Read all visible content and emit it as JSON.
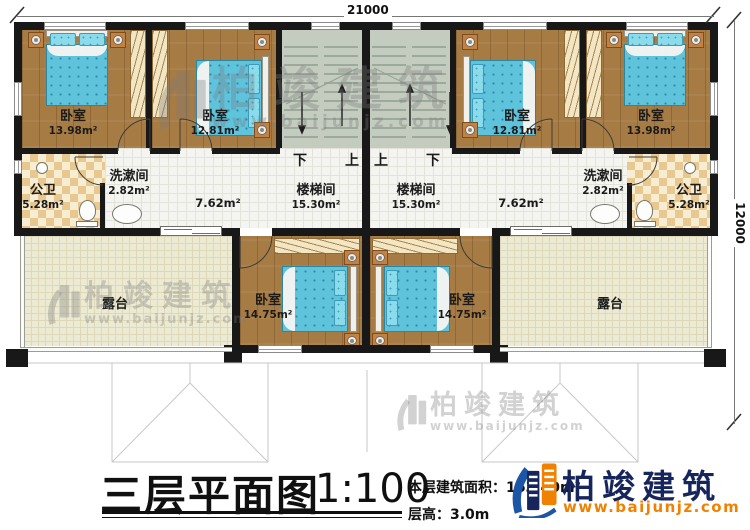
{
  "dimensions": {
    "width_mm": "21000",
    "depth_mm": "12000"
  },
  "stair_directions": {
    "left_down": "下",
    "left_up": "上",
    "right_up": "上",
    "right_down": "下"
  },
  "rooms": {
    "bedroom_top_left": {
      "name": "卧室",
      "area": "13.98m²"
    },
    "bedroom_top_mid_left": {
      "name": "卧室",
      "area": "12.81m²"
    },
    "bedroom_top_mid_right": {
      "name": "卧室",
      "area": "12.81m²"
    },
    "bedroom_top_right": {
      "name": "卧室",
      "area": "13.98m²"
    },
    "bathroom_left": {
      "name": "公卫",
      "area": "5.28m²"
    },
    "bathroom_right": {
      "name": "公卫",
      "area": "5.28m²"
    },
    "washroom_left": {
      "name": "洗漱间",
      "area": "2.82m²"
    },
    "washroom_right": {
      "name": "洗漱间",
      "area": "2.82m²"
    },
    "stairwell_left": {
      "name": "楼梯间",
      "area": "15.30m²"
    },
    "stairwell_right": {
      "name": "楼梯间",
      "area": "15.30m²"
    },
    "hall_left": {
      "area": "7.62m²"
    },
    "hall_right": {
      "area": "7.62m²"
    },
    "bedroom_bottom_left": {
      "name": "卧室",
      "area": "14.75m²"
    },
    "bedroom_bottom_right": {
      "name": "卧室",
      "area": "14.75m²"
    },
    "terrace_left": {
      "name": "露台"
    },
    "terrace_right": {
      "name": "露台"
    }
  },
  "title_block": {
    "title": "三层平面图",
    "scale": "1:100",
    "area_line": "本层建筑面积：163.40m²",
    "height_line": "层高：3.0m"
  },
  "brand": {
    "name": "柏竣建筑",
    "website": "www.baijunjz.com",
    "navy": "#16265c",
    "orange": "#ef8200"
  },
  "watermark": {
    "name": "柏竣建筑",
    "website": "www.baijunjz.com"
  }
}
